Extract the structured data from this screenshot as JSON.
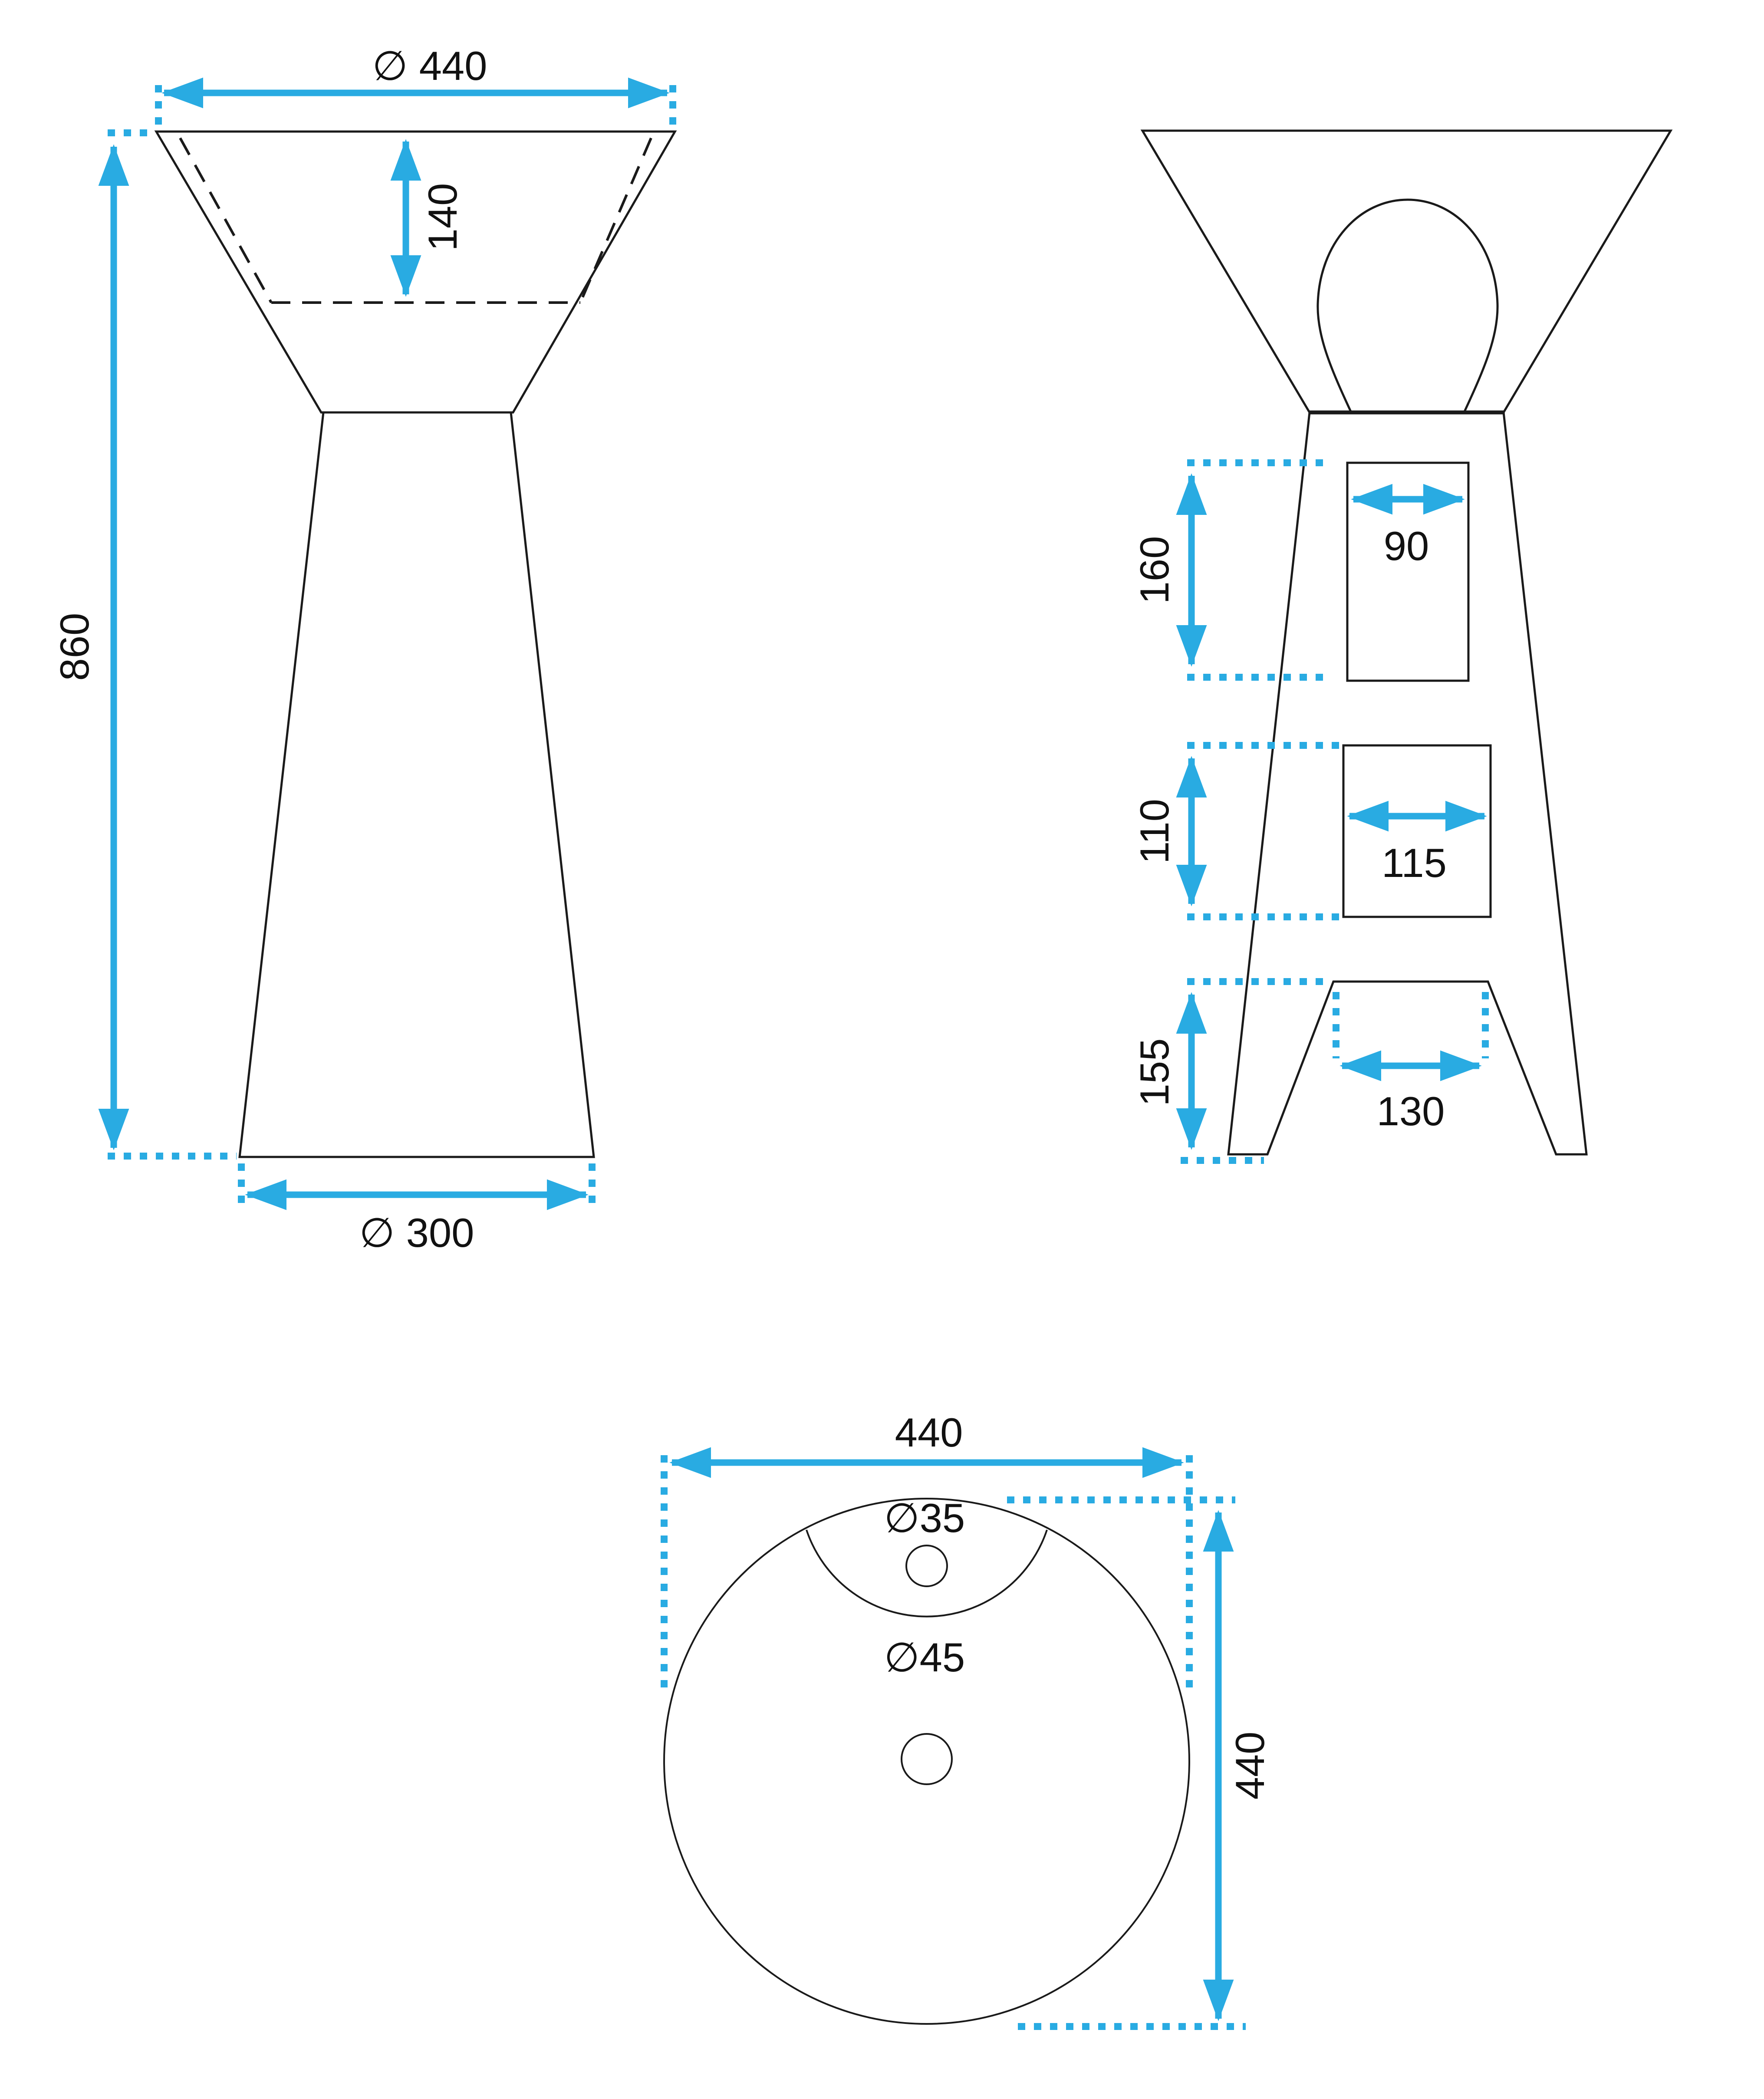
{
  "drawing": {
    "type": "pedestal-washbasin-technical-drawing",
    "colors": {
      "dimension": "#29ABE2",
      "outline": "#1A1A1A",
      "background": "#FFFFFF"
    },
    "front_view": {
      "top_diameter": "∅ 440",
      "basin_inner_depth": "140",
      "total_height": "860",
      "base_diameter": "∅ 300"
    },
    "back_view": {
      "upper_opening_height": "160",
      "upper_opening_width": "90",
      "middle_opening_height": "110",
      "middle_opening_width": "115",
      "base_opening_height": "155",
      "base_opening_width": "130"
    },
    "top_view": {
      "overall_width": "440",
      "overall_depth": "440",
      "faucet_hole_diameter": "∅35",
      "drain_hole_diameter": "∅45"
    }
  }
}
